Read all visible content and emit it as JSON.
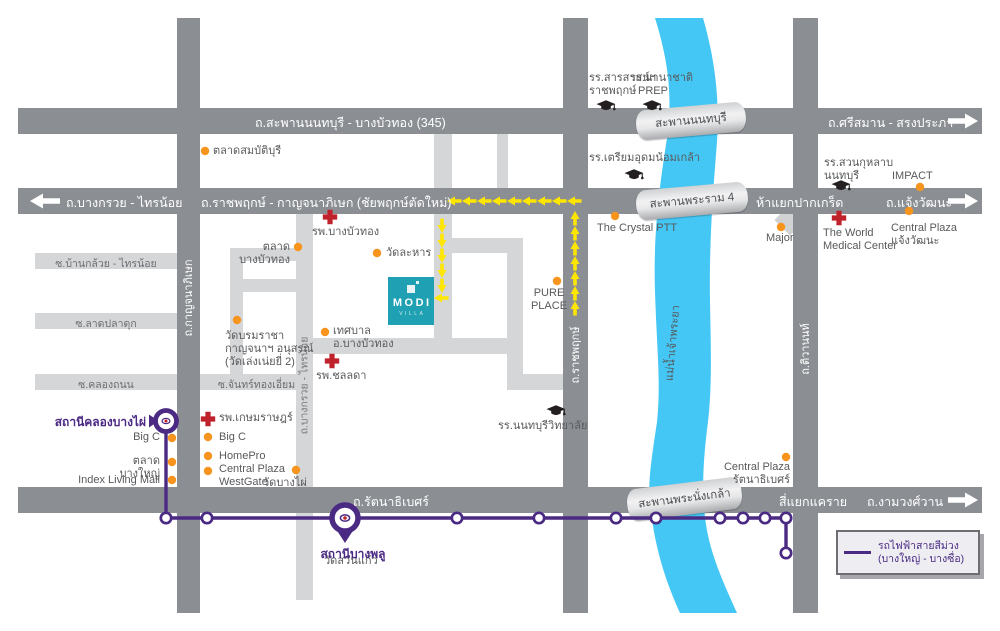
{
  "roads": {
    "r345": "ถ.สะพานนนทบุรี - บางบัวทอง (345)",
    "srisaman": "ถ.ศรีสมาน - สรงประภา",
    "bangkruai_sainoi_west": "ถ.บางกรวย - ไทรน้อย",
    "ratchaphruek_kanchana": "ถ.ราชพฤกษ์ - กาญจนาภิเษก (ชัยพฤกษ์ตัดใหม่)",
    "ha_yaek_pakkret": "ห้าแยกปากเกร็ด",
    "chaengwattana": "ถ.แจ้งวัฒนะ",
    "rattanathibet": "ถ.รัตนาธิเบศร์",
    "si_yaek_khaerai": "สี่แยกแคราย",
    "ngamwongwan": "ถ.งามวงศ์วาน",
    "kanchanaphisek_v": "ถ.กาญจนาภิเษก",
    "ratchaphruek_v": "ถ.ราชพฤกษ์",
    "tiwanon_v": "ถ.ติวานนท์",
    "bangkruai_sainoi_v": "ถ.บางกรวย - ไทรน้อย",
    "soi_bankluai": "ซ.บ้านกล้วย - ไทรน้อย",
    "soi_latpladuk": "ซ.ลาดปลาดุก",
    "soi_khlongthanon": "ซ.คลองถนน",
    "soi_chanthong": "ซ.จันทร์ทองเอี่ยม"
  },
  "bridges": {
    "nonthaburi": "สะพานนนทบุรี",
    "rama4": "สะพานพระราม 4",
    "phranangklao": "สะพานพระนั่งเกล้า"
  },
  "river_label": "แม่น้ำเจ้าพระยา",
  "landmarks": {
    "talat_sombatburi": "ตลาดสมบัติบุรี",
    "talat_bangbuathong": "ตลาดบางบัวทอง",
    "wat_lahan": "วัดละหาร",
    "hosp_bangbuathong": "รพ.บางบัวทอง",
    "wat_borommaracha": "วัดบรมราชา\nกาญจนาฯ อนุสรณ์\n(วัดเล่งเน่ยยี่ 2)",
    "tessaban": "เทศบาล\nอ.บางบัวทอง",
    "hosp_chonlada": "รพ.ชลลดา",
    "school_sarasas": "รร.สารสาสน์ฯ\nราชพฤกษ์",
    "school_prep": "รร.นานาชาติ\nPREP",
    "school_triamudom": "รร.เตรียมอุดมน้อมเกล้า",
    "school_suankularb": "รร.สวนกุหลาบ\nนนทบุรี",
    "school_nonthaburi": "รร.นนทบุรีวิทยาลัย",
    "pure_place": "PURE\nPLACE",
    "crystal_ptt": "The Crystal PTT",
    "impact": "IMPACT",
    "major": "Major",
    "world_medical": "The World\nMedical Center",
    "central_chaengwattana": "Central Plaza\nแจ้งวัฒนะ",
    "central_rattanathibet": "Central Plaza\nรัตนาธิเบศร์",
    "central_westgate": "Central Plaza\nWestGate",
    "big_c_bangyai": "Big C",
    "talat_bangyai": "ตลาดบางใหญ่",
    "index_living_mall": "Index Living Mall",
    "hosp_kasemrad": "รพ.เกษมราษฎร์",
    "big_c": "Big C",
    "homepro": "HomePro",
    "wat_bangphai": "วัดบางไผ่",
    "wat_suankaew": "วัดสวนแก้ว"
  },
  "stations": {
    "khlong_bang_phai": "สถานีคลองบางไผ่",
    "bang_phlu": "สถานีบางพลู"
  },
  "project": {
    "name": "MODI",
    "sub": "VILLA"
  },
  "legend": {
    "text": "รถไฟฟ้าสายสีม่วง\n(บางใหญ่ - บางซื่อ)"
  },
  "colors": {
    "purple_line": "#4b2a84",
    "poi_orange": "#f7941e",
    "hospital_red": "#c0222b",
    "river_blue": "#44c7f4",
    "road_dark": "#8b8f94",
    "road_light": "#d5d6d8",
    "route_yellow": "#ffe600",
    "modi_teal": "#1fa0b3"
  }
}
